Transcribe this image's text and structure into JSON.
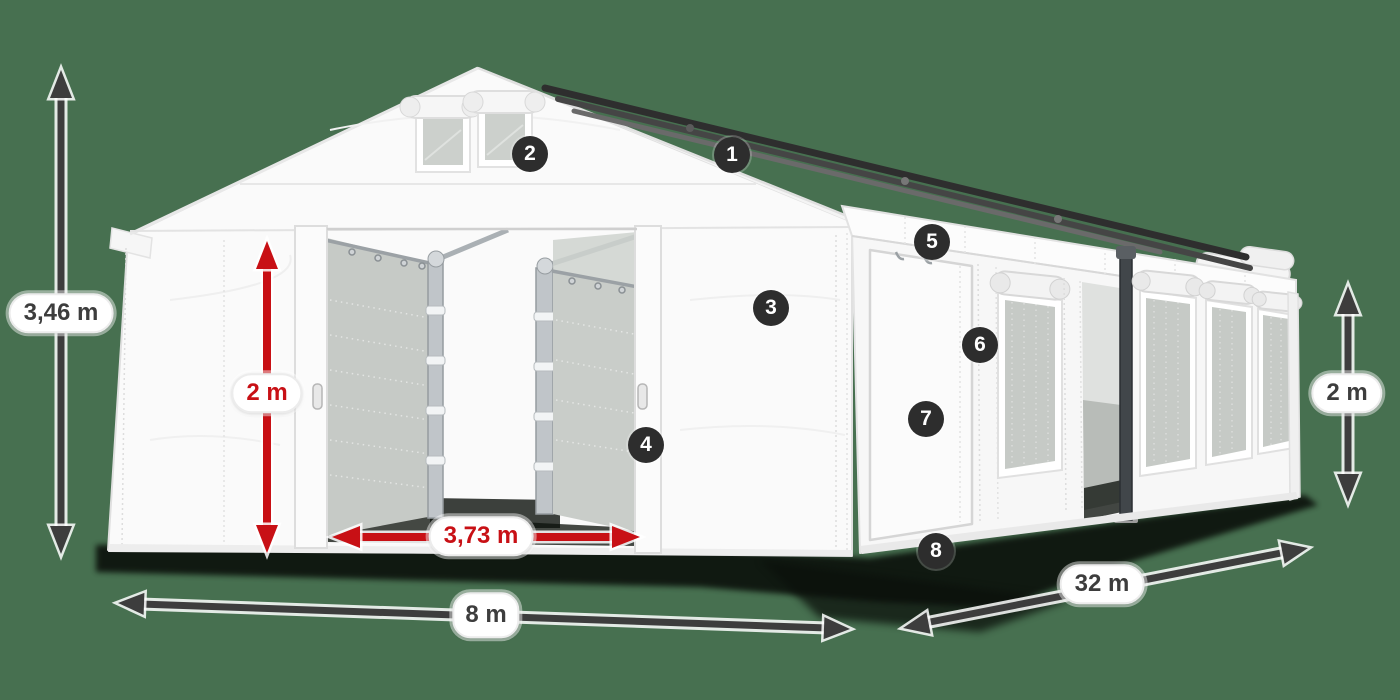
{
  "colors": {
    "background": "#477050",
    "dimension_dark": "#3d3d3d",
    "dimension_red": "#c81015",
    "badge_background": "#2d2d2d",
    "badge_text": "#ffffff",
    "label_background": "#ffffff"
  },
  "dimensions": [
    {
      "id": "total-height",
      "label": "3,46 m",
      "style": "dark"
    },
    {
      "id": "entrance-height",
      "label": "2 m",
      "style": "red"
    },
    {
      "id": "entrance-width",
      "label": "3,73 m",
      "style": "red"
    },
    {
      "id": "gable-width",
      "label": "8 m",
      "style": "dark"
    },
    {
      "id": "side-length",
      "label": "32 m",
      "style": "dark"
    },
    {
      "id": "side-wall-height",
      "label": "2 m",
      "style": "dark"
    }
  ],
  "badges": [
    {
      "number": "1"
    },
    {
      "number": "2"
    },
    {
      "number": "3"
    },
    {
      "number": "4"
    },
    {
      "number": "5"
    },
    {
      "number": "6"
    },
    {
      "number": "7"
    },
    {
      "number": "8"
    }
  ]
}
